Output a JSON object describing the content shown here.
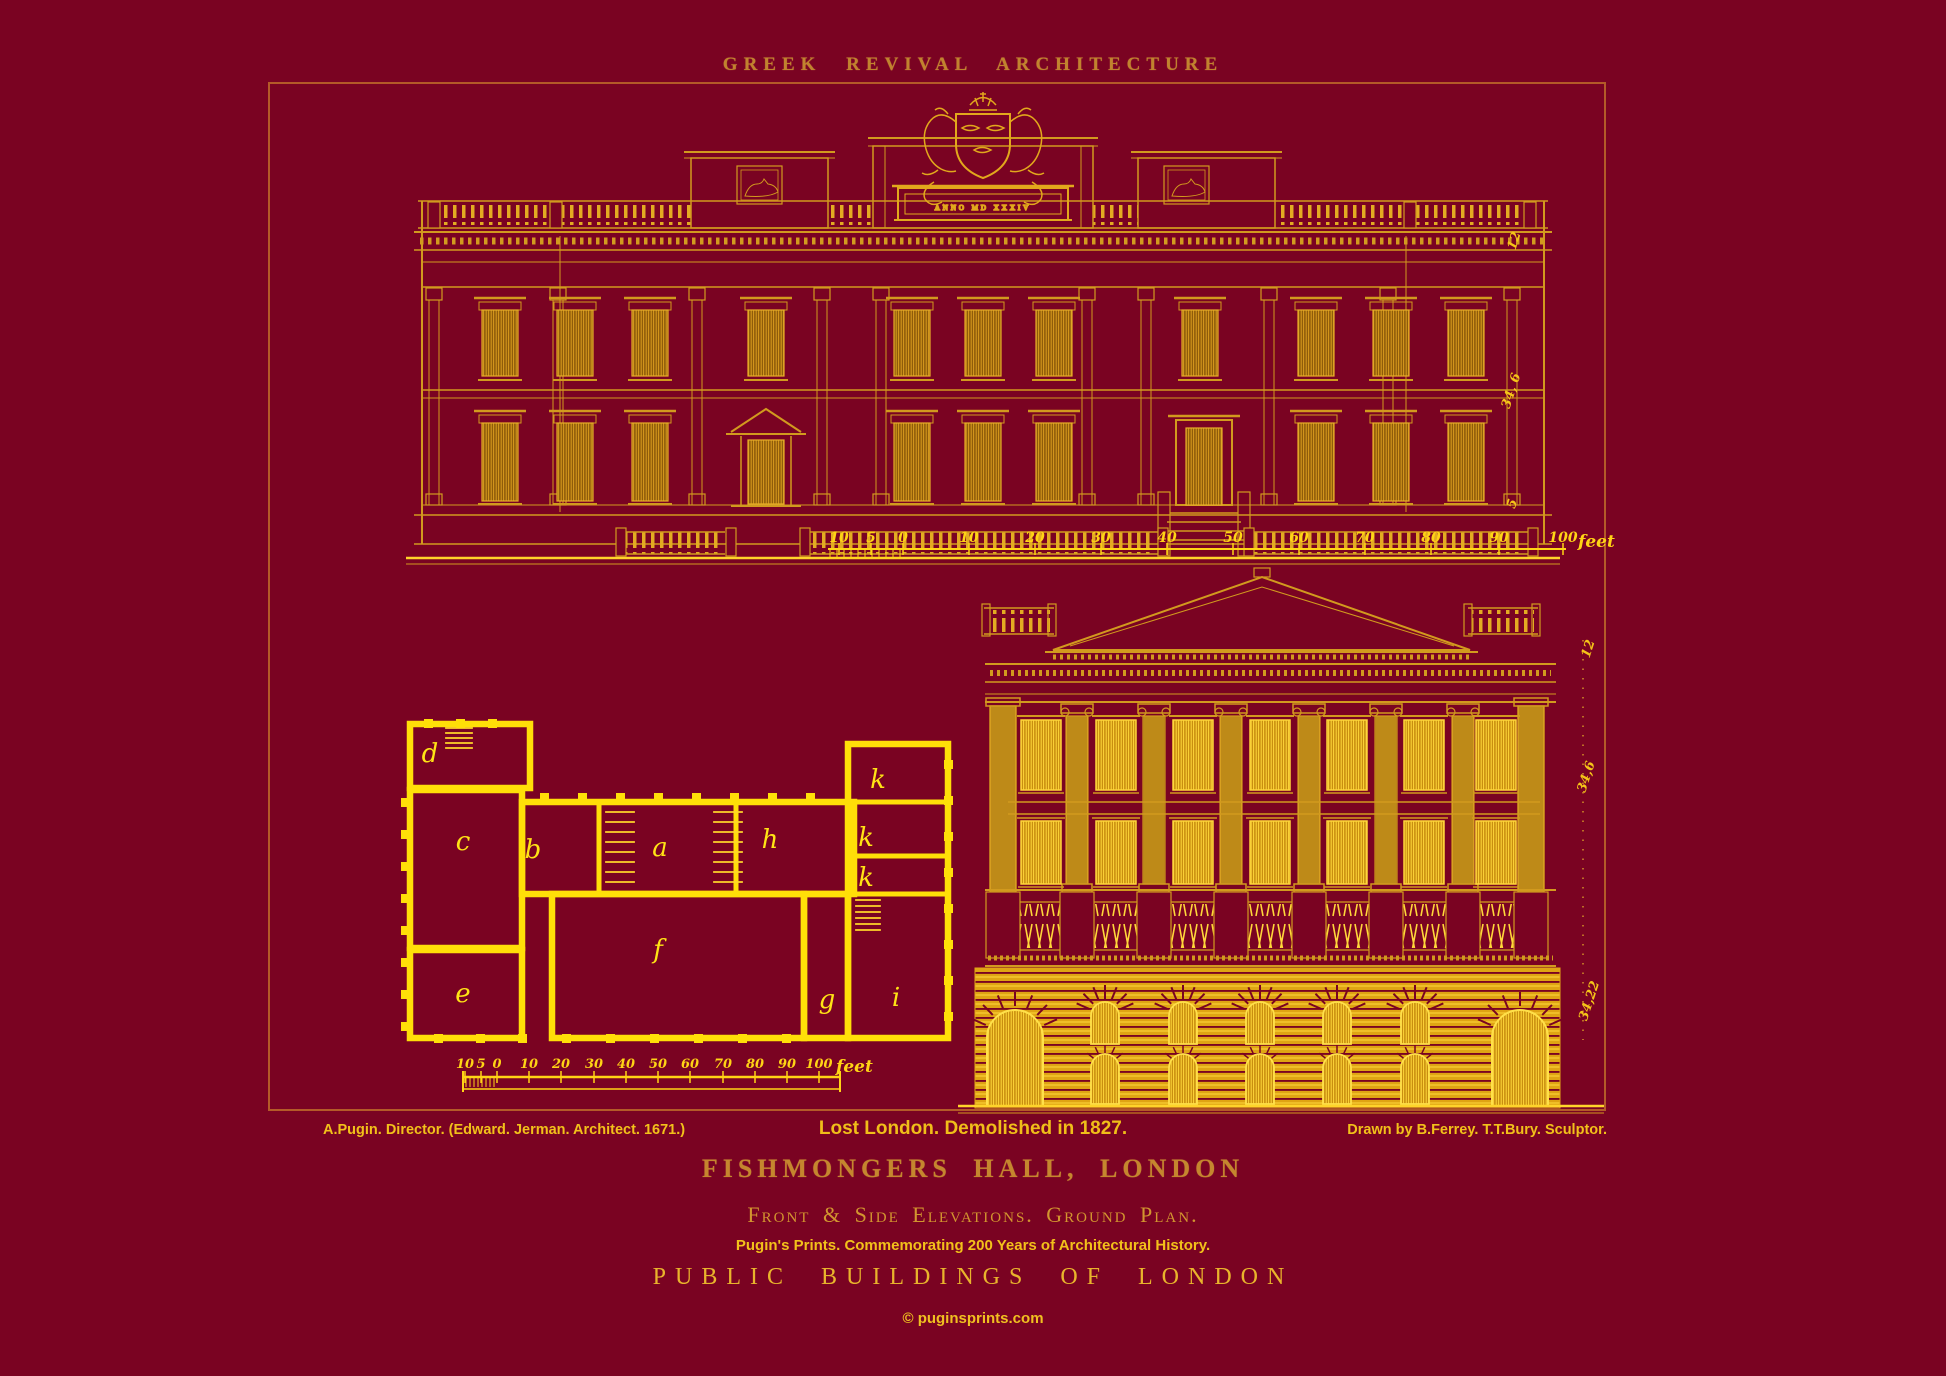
{
  "header_title": "GREEK REVIVAL ARCHITECTURE",
  "attribution_left": "A.Pugin. Director. (Edward. Jerman. Architect. 1671.)",
  "caption_center": "Lost London. Demolished in 1827.",
  "attribution_right": "Drawn by B.Ferrey. T.T.Bury. Sculptor.",
  "title_main": "FISHMONGERS HALL, LONDON",
  "title_sub": "Front & Side Elevations. Ground Plan.",
  "commemoration": "Pugin's Prints. Commemorating 200 Years of Architectural History.",
  "series_title": "PUBLIC BUILDINGS OF LONDON",
  "website": "© puginsprints.com",
  "coat_of_arms_inscription": "ANNO MD XXXIV",
  "scale_ruler": {
    "labels": [
      "10",
      "5",
      "0",
      "10",
      "20",
      "30",
      "40",
      "50",
      "60",
      "70",
      "80",
      "90",
      "100"
    ],
    "unit": "feet"
  },
  "measurements": {
    "front_elevation": [
      "12",
      "34, 6",
      "5"
    ],
    "side_elevation": [
      "12",
      "34,6",
      "34,22"
    ]
  },
  "plan_rooms": [
    {
      "label": "d"
    },
    {
      "label": "c"
    },
    {
      "label": "b"
    },
    {
      "label": "a"
    },
    {
      "label": "h"
    },
    {
      "label": "k"
    },
    {
      "label": "k"
    },
    {
      "label": "k"
    },
    {
      "label": "e"
    },
    {
      "label": "f"
    },
    {
      "label": "g"
    },
    {
      "label": "i"
    }
  ],
  "colors": {
    "background": "#7a0322",
    "frame": "#b45a28",
    "gold": "#d29a1e",
    "bright_gold": "#ffd42a",
    "plan_yellow": "#ffdf08",
    "title_gold": "#c5862e",
    "text_yellow": "#f2c11a"
  }
}
